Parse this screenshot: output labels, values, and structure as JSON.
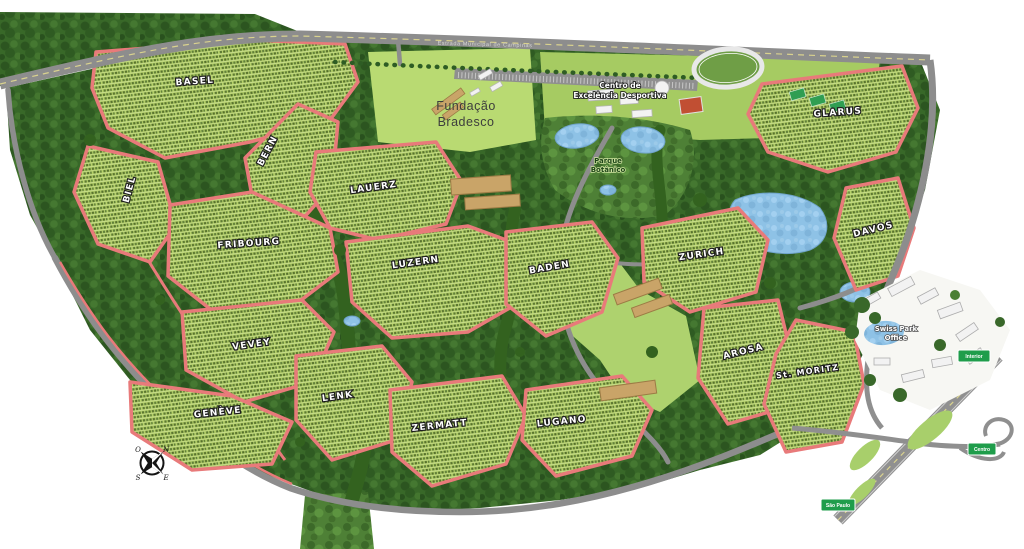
{
  "map_title": "Swiss Park residential masterplan map",
  "districts": [
    {
      "name": "BASEL"
    },
    {
      "name": "BERN"
    },
    {
      "name": "BIEL"
    },
    {
      "name": "FRIBOURG"
    },
    {
      "name": "LAUERZ"
    },
    {
      "name": "LUZERN"
    },
    {
      "name": "BADEN"
    },
    {
      "name": "ZURICH"
    },
    {
      "name": "GLARUS"
    },
    {
      "name": "DAVOS"
    },
    {
      "name": "AROSA"
    },
    {
      "name": "St. MORITZ"
    },
    {
      "name": "VEVEY"
    },
    {
      "name": "GENÈVE"
    },
    {
      "name": "LENK"
    },
    {
      "name": "ZERMATT"
    },
    {
      "name": "LUGANO"
    }
  ],
  "places": {
    "fundacao": {
      "line1": "Fundação",
      "line2": "Bradesco"
    },
    "sports_center": {
      "line1": "Centro de",
      "line2": "Excelência Desportiva"
    },
    "botanic_park": {
      "line1": "Parque",
      "line2": "Botânico"
    },
    "office": {
      "line1": "Swiss Park",
      "line2": "Office"
    }
  },
  "road_label": "Estrada Municipal de Campinas",
  "signs": {
    "north": "Interior",
    "east": "Centro",
    "south": "São Paulo"
  },
  "compass": {
    "n": "N",
    "e": "E",
    "s": "S",
    "o": "O"
  },
  "colors": {
    "district_outline": "#e87a7a",
    "forest": "#386828",
    "lots": "#b5d169",
    "water": "#8ec2e6",
    "road": "#8d8d8d",
    "sign_green": "#1f9d4b",
    "barn": "#c9a468"
  }
}
